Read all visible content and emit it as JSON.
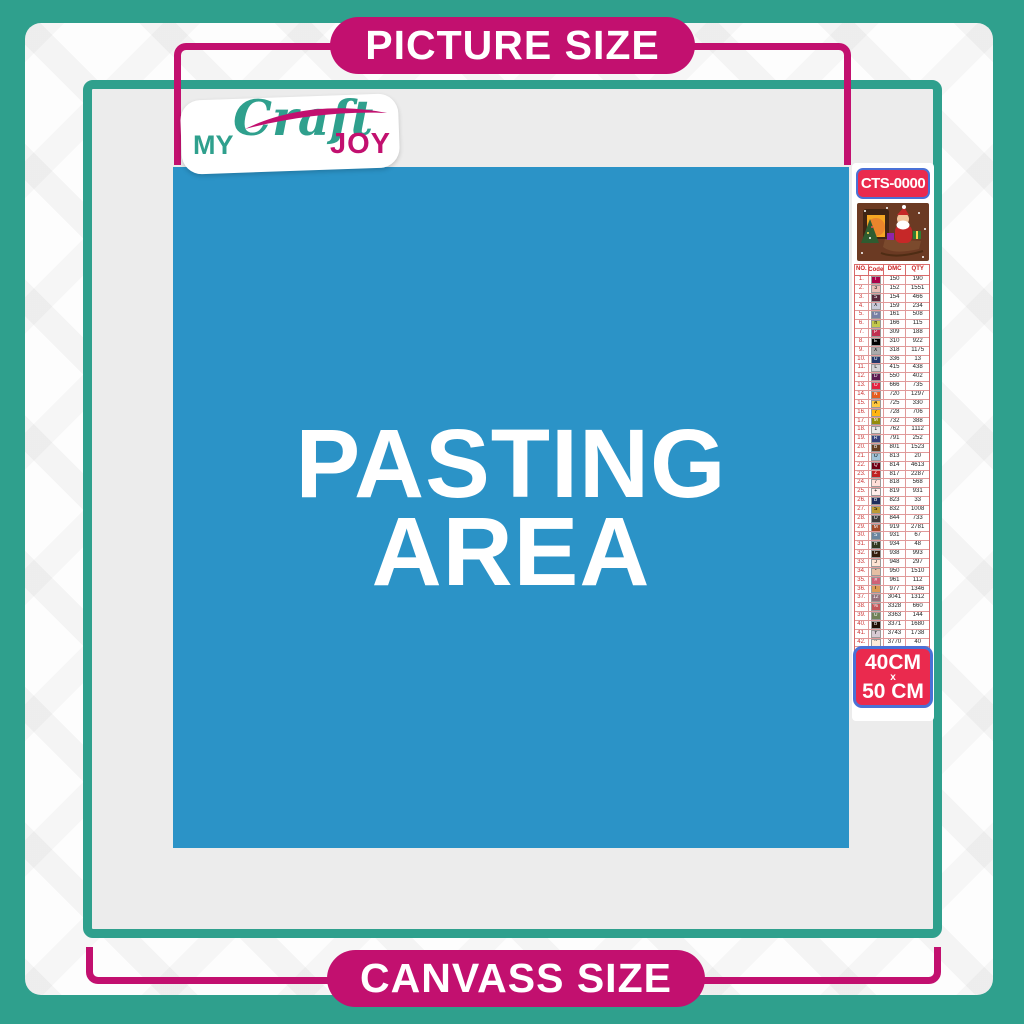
{
  "theme": {
    "teal": "#2FA08D",
    "magenta": "#C2106F",
    "red": "#EA2A4E",
    "blueBorder": "#4A71D6",
    "blue": "#2B93C7",
    "canvas": "#ECECEC"
  },
  "banners": {
    "top": "PICTURE SIZE",
    "bottom": "CANVASS SIZE"
  },
  "logo": {
    "word1": "MY",
    "word2": "Craft",
    "word3": "JOY"
  },
  "pasting_area": {
    "line1": "PASTING",
    "line2": "AREA"
  },
  "sidebar": {
    "product_code": "CTS-0000",
    "preview_alt": "christmas santa sleigh scene",
    "size_badge": {
      "line1": "40CM",
      "line2": "x",
      "line3": "50 CM"
    },
    "table": {
      "headers": [
        "NO.",
        "Code",
        "DMC",
        "QTY"
      ],
      "rows": [
        {
          "no": "1.",
          "sym": "T",
          "hex": "#AB0249",
          "dmc": "150",
          "qty": "190"
        },
        {
          "no": "2.",
          "sym": "3",
          "hex": "#E8BDB6",
          "dmc": "152",
          "qty": "1551"
        },
        {
          "no": "3.",
          "sym": "S",
          "hex": "#57273B",
          "dmc": "154",
          "qty": "466"
        },
        {
          "no": "4.",
          "sym": "X",
          "hex": "#C7CAD7",
          "dmc": "159",
          "qty": "234"
        },
        {
          "no": "5.",
          "sym": "G",
          "hex": "#7880A4",
          "dmc": "161",
          "qty": "508"
        },
        {
          "no": "6.",
          "sym": "h",
          "hex": "#C3C94E",
          "dmc": "166",
          "qty": "115"
        },
        {
          "no": "7.",
          "sym": "P",
          "hex": "#C03050",
          "dmc": "309",
          "qty": "188"
        },
        {
          "no": "8.",
          "sym": "E",
          "hex": "#000000",
          "dmc": "310",
          "qty": "922"
        },
        {
          "no": "9.",
          "sym": "X",
          "hex": "#ABABAB",
          "dmc": "318",
          "qty": "1175"
        },
        {
          "no": "10.",
          "sym": "U",
          "hex": "#25396B",
          "dmc": "336",
          "qty": "13"
        },
        {
          "no": "11.",
          "sym": "L",
          "hex": "#D3D3D6",
          "dmc": "415",
          "qty": "438"
        },
        {
          "no": "12.",
          "sym": "D",
          "hex": "#5C1B50",
          "dmc": "550",
          "qty": "402"
        },
        {
          "no": "13.",
          "sym": "O",
          "hex": "#E3233F",
          "dmc": "666",
          "qty": "735"
        },
        {
          "no": "14.",
          "sym": "N",
          "hex": "#E55C1F",
          "dmc": "720",
          "qty": "1297"
        },
        {
          "no": "15.",
          "sym": "A",
          "hex": "#FFC840",
          "dmc": "725",
          "qty": "330"
        },
        {
          "no": "16.",
          "sym": "7",
          "hex": "#FFB514",
          "dmc": "728",
          "qty": "706"
        },
        {
          "no": "17.",
          "sym": "M",
          "hex": "#948C0A",
          "dmc": "732",
          "qty": "388"
        },
        {
          "no": "18.",
          "sym": "1",
          "hex": "#E8E8E8",
          "dmc": "762",
          "qty": "1112"
        },
        {
          "no": "19.",
          "sym": "R",
          "hex": "#36427E",
          "dmc": "791",
          "qty": "252"
        },
        {
          "no": "20.",
          "sym": "B",
          "hex": "#653E23",
          "dmc": "801",
          "qty": "1523"
        },
        {
          "no": "21.",
          "sym": "O",
          "hex": "#A1C2D7",
          "dmc": "813",
          "qty": "20"
        },
        {
          "no": "22.",
          "sym": "Q",
          "hex": "#700014",
          "dmc": "814",
          "qty": "4613"
        },
        {
          "no": "23.",
          "sym": "Z",
          "hex": "#C02020",
          "dmc": "817",
          "qty": "2287"
        },
        {
          "no": "24.",
          "sym": "7",
          "hex": "#FFDFD9",
          "dmc": "818",
          "qty": "568"
        },
        {
          "no": "25.",
          "sym": "+",
          "hex": "#FFEEEB",
          "dmc": "819",
          "qty": "931"
        },
        {
          "no": "26.",
          "sym": "B",
          "hex": "#1F2D5C",
          "dmc": "823",
          "qty": "33"
        },
        {
          "no": "27.",
          "sym": "S",
          "hex": "#BD9B33",
          "dmc": "832",
          "qty": "1008"
        },
        {
          "no": "28.",
          "sym": "O",
          "hex": "#3E3E3E",
          "dmc": "844",
          "qty": "733"
        },
        {
          "no": "29.",
          "sym": "M",
          "hex": "#A34A28",
          "dmc": "919",
          "qty": "2781"
        },
        {
          "no": "30.",
          "sym": "S",
          "hex": "#6A859E",
          "dmc": "931",
          "qty": "67"
        },
        {
          "no": "31.",
          "sym": "H",
          "hex": "#31381F",
          "dmc": "934",
          "qty": "48"
        },
        {
          "no": "32.",
          "sym": "G",
          "hex": "#331D0D",
          "dmc": "938",
          "qty": "993"
        },
        {
          "no": "33.",
          "sym": "J",
          "hex": "#FEE3D3",
          "dmc": "948",
          "qty": "297"
        },
        {
          "no": "34.",
          "sym": "*",
          "hex": "#E6BFA4",
          "dmc": "950",
          "qty": "1510"
        },
        {
          "no": "35.",
          "sym": "#",
          "hex": "#CF6277",
          "dmc": "961",
          "qty": "112"
        },
        {
          "no": "36.",
          "sym": "T",
          "hex": "#DC9C56",
          "dmc": "977",
          "qty": "1346"
        },
        {
          "no": "37.",
          "sym": "12",
          "hex": "#95707C",
          "dmc": "3041",
          "qty": "1312"
        },
        {
          "no": "38.",
          "sym": "%",
          "hex": "#C4565A",
          "dmc": "3328",
          "qty": "660"
        },
        {
          "no": "39.",
          "sym": "U",
          "hex": "#6F8157",
          "dmc": "3363",
          "qty": "144"
        },
        {
          "no": "40.",
          "sym": "B",
          "hex": "#1E1106",
          "dmc": "3371",
          "qty": "1680"
        },
        {
          "no": "41.",
          "sym": "Y",
          "hex": "#D7CBD3",
          "dmc": "3743",
          "qty": "1738"
        },
        {
          "no": "42.",
          "sym": "^",
          "hex": "#FFEAD9",
          "dmc": "3770",
          "qty": "40"
        },
        {
          "no": "43.",
          "sym": "V",
          "hex": "#D2BCA6",
          "dmc": "3782",
          "qty": "617"
        },
        {
          "no": "44.",
          "sym": "2",
          "hex": "#DDE26A",
          "dmc": "3819",
          "qty": "119"
        },
        {
          "no": "45.",
          "sym": "/",
          "hex": "#FCF8D8",
          "dmc": "3823",
          "qty": "107"
        },
        {
          "no": "46.",
          "sym": "C",
          "hex": "#F29746",
          "dmc": "3853",
          "qty": "1332"
        },
        {
          "no": "47.",
          "sym": "13",
          "hex": "#8E4A3E",
          "dmc": "3858",
          "qty": "2311"
        },
        {
          "no": "48.",
          "sym": "A",
          "hex": "#A4835C",
          "dmc": "3863",
          "qty": "1820"
        }
      ]
    }
  }
}
